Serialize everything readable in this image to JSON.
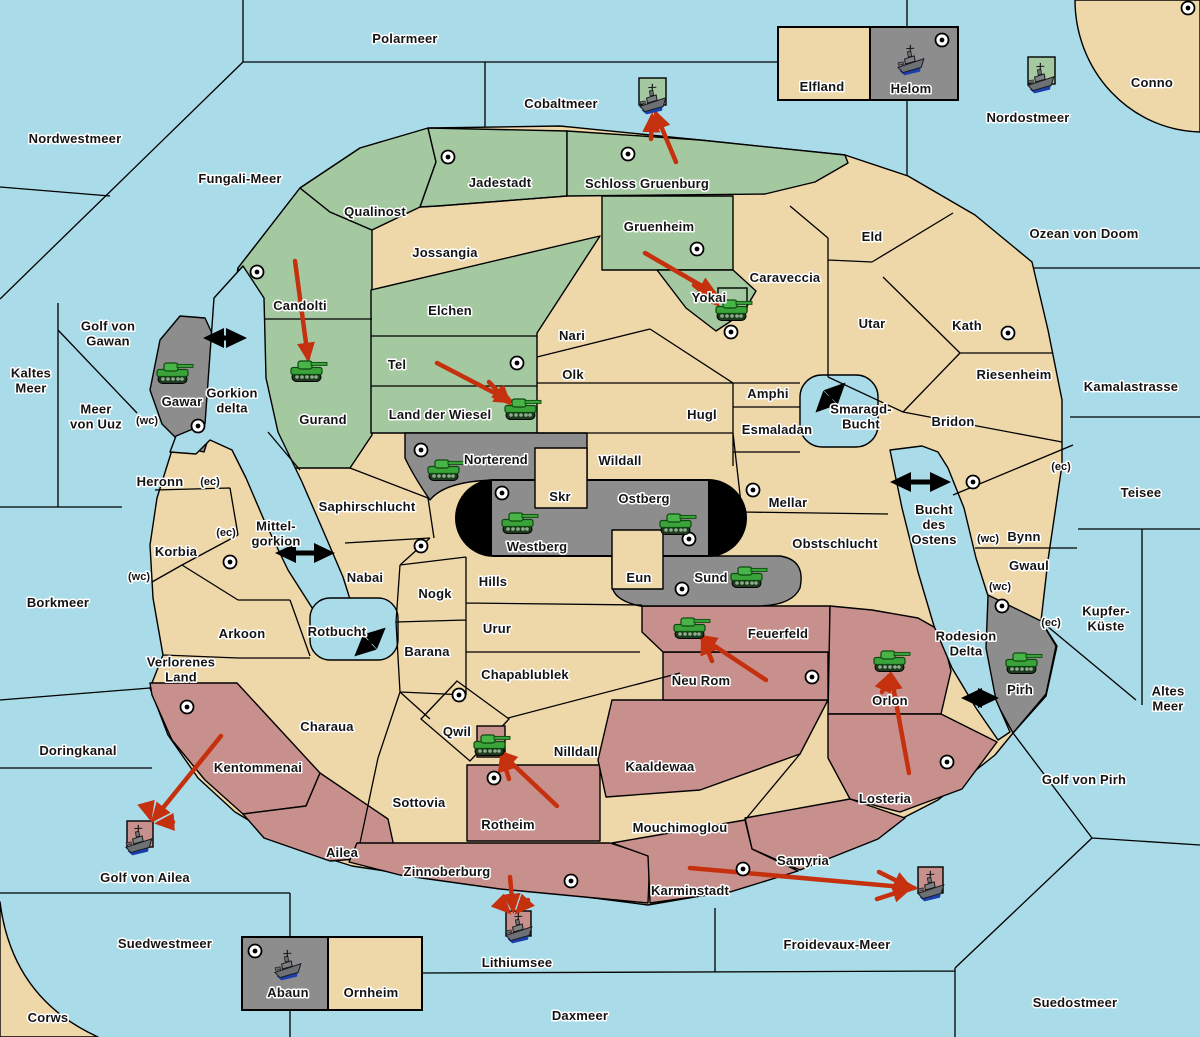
{
  "map": {
    "size": {
      "w": 1200,
      "h": 1037
    },
    "colors": {
      "sea": "#a9dbe8",
      "land": "#eed7a8",
      "green": "#a4c8a0",
      "gray": "#8d8d8d",
      "rose": "#c8908c",
      "black": "#000000",
      "arrow_red": "#c5310e",
      "label": "#141414",
      "halo": "#ffffff",
      "tank": "#3aa33a",
      "ship_hull": "#6d7175",
      "ship_keel": "#1c3fae"
    },
    "labels": [
      {
        "t": [
          "Polarmeer"
        ],
        "x": 405,
        "y": 38,
        "k": "sea"
      },
      {
        "t": [
          "Nordwestmeer"
        ],
        "x": 75,
        "y": 138,
        "k": "sea"
      },
      {
        "t": [
          "Fungali-Meer"
        ],
        "x": 240,
        "y": 178,
        "k": "sea"
      },
      {
        "t": [
          "Cobaltmeer"
        ],
        "x": 561,
        "y": 103,
        "k": "sea"
      },
      {
        "t": [
          "Nordostmeer"
        ],
        "x": 1028,
        "y": 117,
        "k": "sea"
      },
      {
        "t": [
          "Conno"
        ],
        "x": 1152,
        "y": 82,
        "k": "land"
      },
      {
        "t": [
          "Ozean von Doom"
        ],
        "x": 1084,
        "y": 233,
        "k": "sea"
      },
      {
        "t": [
          "Kamalastrasse"
        ],
        "x": 1131,
        "y": 386,
        "k": "sea"
      },
      {
        "t": [
          "Teisee"
        ],
        "x": 1141,
        "y": 492,
        "k": "sea"
      },
      {
        "t": [
          "Kupfer-",
          "Küste"
        ],
        "x": 1106,
        "y": 618,
        "k": "sea"
      },
      {
        "t": [
          "Altes",
          "Meer"
        ],
        "x": 1168,
        "y": 698,
        "k": "sea"
      },
      {
        "t": [
          "Golf von Pirh"
        ],
        "x": 1084,
        "y": 779,
        "k": "sea"
      },
      {
        "t": [
          "Froidevaux-Meer"
        ],
        "x": 837,
        "y": 944,
        "k": "sea"
      },
      {
        "t": [
          "Suedostmeer"
        ],
        "x": 1075,
        "y": 1002,
        "k": "sea"
      },
      {
        "t": [
          "Daxmeer"
        ],
        "x": 580,
        "y": 1015,
        "k": "sea"
      },
      {
        "t": [
          "Suedwestmeer"
        ],
        "x": 165,
        "y": 943,
        "k": "sea"
      },
      {
        "t": [
          "Corws"
        ],
        "x": 48,
        "y": 1017,
        "k": "land"
      },
      {
        "t": [
          "Doringkanal"
        ],
        "x": 78,
        "y": 750,
        "k": "sea"
      },
      {
        "t": [
          "Borkmeer"
        ],
        "x": 58,
        "y": 602,
        "k": "sea"
      },
      {
        "t": [
          "Kaltes",
          "Meer"
        ],
        "x": 31,
        "y": 380,
        "k": "sea"
      },
      {
        "t": [
          "Meer",
          "von Uuz"
        ],
        "x": 96,
        "y": 416,
        "k": "sea"
      },
      {
        "t": [
          "Golf von",
          "Gawan"
        ],
        "x": 108,
        "y": 333,
        "k": "sea"
      },
      {
        "t": [
          "Golf von Ailea"
        ],
        "x": 145,
        "y": 877,
        "k": "sea"
      },
      {
        "t": [
          "Lithiumsee"
        ],
        "x": 517,
        "y": 962,
        "k": "sea"
      },
      {
        "t": [
          "Gorkion",
          "delta"
        ],
        "x": 232,
        "y": 400,
        "k": "sea"
      },
      {
        "t": [
          "Mittel-",
          "gorkion"
        ],
        "x": 276,
        "y": 533,
        "k": "sea"
      },
      {
        "t": [
          "Rotbucht"
        ],
        "x": 337,
        "y": 631,
        "k": "sea"
      },
      {
        "t": [
          "Smaragd-",
          "Bucht"
        ],
        "x": 861,
        "y": 416,
        "k": "sea"
      },
      {
        "t": [
          "Bucht",
          "des",
          "Ostens"
        ],
        "x": 934,
        "y": 524,
        "k": "sea"
      },
      {
        "t": [
          "Rodesion",
          "Delta"
        ],
        "x": 966,
        "y": 643,
        "k": "sea"
      },
      {
        "t": [
          "Jadestadt"
        ],
        "x": 500,
        "y": 182,
        "k": "land"
      },
      {
        "t": [
          "Schloss Gruenburg"
        ],
        "x": 647,
        "y": 183,
        "k": "land"
      },
      {
        "t": [
          "Qualinost"
        ],
        "x": 375,
        "y": 211,
        "k": "land"
      },
      {
        "t": [
          "Jossangia"
        ],
        "x": 445,
        "y": 252,
        "k": "land"
      },
      {
        "t": [
          "Gruenheim"
        ],
        "x": 659,
        "y": 226,
        "k": "land"
      },
      {
        "t": [
          "Candolti"
        ],
        "x": 300,
        "y": 305,
        "k": "land"
      },
      {
        "t": [
          "Elchen"
        ],
        "x": 450,
        "y": 310,
        "k": "land"
      },
      {
        "t": [
          "Tel"
        ],
        "x": 397,
        "y": 364,
        "k": "land"
      },
      {
        "t": [
          "Nari"
        ],
        "x": 572,
        "y": 335,
        "k": "land"
      },
      {
        "t": [
          "Olk"
        ],
        "x": 573,
        "y": 374,
        "k": "land"
      },
      {
        "t": [
          "Land der Wiesel"
        ],
        "x": 440,
        "y": 414,
        "k": "land"
      },
      {
        "t": [
          "Gurand"
        ],
        "x": 323,
        "y": 419,
        "k": "land"
      },
      {
        "t": [
          "Gawar"
        ],
        "x": 182,
        "y": 401,
        "k": "land"
      },
      {
        "t": [
          "Yokai"
        ],
        "x": 709,
        "y": 297,
        "k": "land"
      },
      {
        "t": [
          "Caraveccia"
        ],
        "x": 785,
        "y": 277,
        "k": "land"
      },
      {
        "t": [
          "Eld"
        ],
        "x": 872,
        "y": 236,
        "k": "land"
      },
      {
        "t": [
          "Utar"
        ],
        "x": 872,
        "y": 323,
        "k": "land"
      },
      {
        "t": [
          "Kath"
        ],
        "x": 967,
        "y": 325,
        "k": "land"
      },
      {
        "t": [
          "Riesenheim"
        ],
        "x": 1014,
        "y": 374,
        "k": "land"
      },
      {
        "t": [
          "Bridon"
        ],
        "x": 953,
        "y": 421,
        "k": "land"
      },
      {
        "t": [
          "Amphi"
        ],
        "x": 768,
        "y": 393,
        "k": "land"
      },
      {
        "t": [
          "Esmaladan"
        ],
        "x": 777,
        "y": 429,
        "k": "land"
      },
      {
        "t": [
          "Hugl"
        ],
        "x": 702,
        "y": 414,
        "k": "land"
      },
      {
        "t": [
          "Wildall"
        ],
        "x": 620,
        "y": 460,
        "k": "land"
      },
      {
        "t": [
          "Skr"
        ],
        "x": 560,
        "y": 496,
        "k": "land"
      },
      {
        "t": [
          "Ostberg"
        ],
        "x": 644,
        "y": 498,
        "k": "land"
      },
      {
        "t": [
          "Westberg"
        ],
        "x": 537,
        "y": 546,
        "k": "land"
      },
      {
        "t": [
          "Norterend"
        ],
        "x": 496,
        "y": 459,
        "k": "land"
      },
      {
        "t": [
          "Eun"
        ],
        "x": 639,
        "y": 577,
        "k": "land"
      },
      {
        "t": [
          "Sund"
        ],
        "x": 711,
        "y": 577,
        "k": "land"
      },
      {
        "t": [
          "Mellar"
        ],
        "x": 788,
        "y": 502,
        "k": "land"
      },
      {
        "t": [
          "Obstschlucht"
        ],
        "x": 835,
        "y": 543,
        "k": "land"
      },
      {
        "t": [
          "Saphirschlucht"
        ],
        "x": 367,
        "y": 506,
        "k": "land"
      },
      {
        "t": [
          "Heronn"
        ],
        "x": 160,
        "y": 481,
        "k": "land"
      },
      {
        "t": [
          "Korbia"
        ],
        "x": 176,
        "y": 551,
        "k": "land"
      },
      {
        "t": [
          "Nabai"
        ],
        "x": 365,
        "y": 577,
        "k": "land"
      },
      {
        "t": [
          "Nogk"
        ],
        "x": 435,
        "y": 593,
        "k": "land"
      },
      {
        "t": [
          "Arkoon"
        ],
        "x": 242,
        "y": 633,
        "k": "land"
      },
      {
        "t": [
          "Verlorenes",
          "Land"
        ],
        "x": 181,
        "y": 669,
        "k": "land"
      },
      {
        "t": [
          "Hills"
        ],
        "x": 493,
        "y": 581,
        "k": "land"
      },
      {
        "t": [
          "Urur"
        ],
        "x": 497,
        "y": 628,
        "k": "land"
      },
      {
        "t": [
          "Barana"
        ],
        "x": 427,
        "y": 651,
        "k": "land"
      },
      {
        "t": [
          "Chapablublek"
        ],
        "x": 525,
        "y": 674,
        "k": "land"
      },
      {
        "t": [
          "Charaua"
        ],
        "x": 327,
        "y": 726,
        "k": "land"
      },
      {
        "t": [
          "Kentommenai"
        ],
        "x": 258,
        "y": 767,
        "k": "land"
      },
      {
        "t": [
          "Sottovia"
        ],
        "x": 419,
        "y": 802,
        "k": "land"
      },
      {
        "t": [
          "Ailea"
        ],
        "x": 342,
        "y": 852,
        "k": "land"
      },
      {
        "t": [
          "Zinnoberburg"
        ],
        "x": 447,
        "y": 871,
        "k": "land"
      },
      {
        "t": [
          "Rotheim"
        ],
        "x": 508,
        "y": 824,
        "k": "land"
      },
      {
        "t": [
          "Qwil"
        ],
        "x": 457,
        "y": 731,
        "k": "land"
      },
      {
        "t": [
          "Nilldall"
        ],
        "x": 576,
        "y": 751,
        "k": "land"
      },
      {
        "t": [
          "Kaaldewaa"
        ],
        "x": 660,
        "y": 766,
        "k": "land"
      },
      {
        "t": [
          "Mouchimoglou"
        ],
        "x": 680,
        "y": 827,
        "k": "land"
      },
      {
        "t": [
          "Neu Rom"
        ],
        "x": 701,
        "y": 680,
        "k": "land"
      },
      {
        "t": [
          "Feuerfeld"
        ],
        "x": 778,
        "y": 633,
        "k": "land"
      },
      {
        "t": [
          "Orlon"
        ],
        "x": 890,
        "y": 700,
        "k": "land"
      },
      {
        "t": [
          "Losteria"
        ],
        "x": 885,
        "y": 798,
        "k": "land"
      },
      {
        "t": [
          "Samyria"
        ],
        "x": 803,
        "y": 860,
        "k": "land"
      },
      {
        "t": [
          "Karminstadt"
        ],
        "x": 690,
        "y": 890,
        "k": "land"
      },
      {
        "t": [
          "Bynn"
        ],
        "x": 1024,
        "y": 536,
        "k": "land"
      },
      {
        "t": [
          "Gwaul"
        ],
        "x": 1029,
        "y": 565,
        "k": "land"
      },
      {
        "t": [
          "Pirh"
        ],
        "x": 1020,
        "y": 689,
        "k": "land"
      },
      {
        "t": [
          "Elfland"
        ],
        "x": 822,
        "y": 86,
        "k": "land"
      },
      {
        "t": [
          "Helom"
        ],
        "x": 911,
        "y": 88,
        "k": "land"
      },
      {
        "t": [
          "Abaun"
        ],
        "x": 288,
        "y": 992,
        "k": "land"
      },
      {
        "t": [
          "Ornheim"
        ],
        "x": 371,
        "y": 992,
        "k": "land"
      }
    ],
    "coast_markers": [
      {
        "t": "(ec)",
        "x": 210,
        "y": 481
      },
      {
        "t": "(ec)",
        "x": 226,
        "y": 532
      },
      {
        "t": "(wc)",
        "x": 139,
        "y": 576
      },
      {
        "t": "(wc)",
        "x": 147,
        "y": 420
      },
      {
        "t": "(ec)",
        "x": 1061,
        "y": 466
      },
      {
        "t": "(wc)",
        "x": 988,
        "y": 538
      },
      {
        "t": "(wc)",
        "x": 1000,
        "y": 586
      },
      {
        "t": "(ec)",
        "x": 1051,
        "y": 622
      }
    ],
    "supply_centers": [
      [
        448,
        157
      ],
      [
        628,
        154
      ],
      [
        257,
        272
      ],
      [
        697,
        249
      ],
      [
        731,
        332
      ],
      [
        517,
        363
      ],
      [
        198,
        426
      ],
      [
        230,
        562
      ],
      [
        421,
        546
      ],
      [
        421,
        450
      ],
      [
        502,
        493
      ],
      [
        689,
        539
      ],
      [
        682,
        589
      ],
      [
        753,
        490
      ],
      [
        1008,
        333
      ],
      [
        973,
        482
      ],
      [
        1002,
        606
      ],
      [
        187,
        707
      ],
      [
        459,
        695
      ],
      [
        494,
        778
      ],
      [
        812,
        677
      ],
      [
        947,
        762
      ],
      [
        571,
        881
      ],
      [
        743,
        869
      ],
      [
        942,
        40
      ],
      [
        255,
        951
      ],
      [
        1188,
        8
      ]
    ],
    "unit_boxes": [
      {
        "x": 639,
        "y": 78,
        "w": 27,
        "h": 27,
        "c": "green"
      },
      {
        "x": 1028,
        "y": 57,
        "w": 27,
        "h": 27,
        "c": "green"
      },
      {
        "x": 718,
        "y": 288,
        "w": 29,
        "h": 23,
        "c": "green"
      },
      {
        "x": 477,
        "y": 726,
        "w": 28,
        "h": 31,
        "c": "rose"
      },
      {
        "x": 127,
        "y": 821,
        "w": 26,
        "h": 26,
        "c": "rose"
      },
      {
        "x": 506,
        "y": 911,
        "w": 25,
        "h": 25,
        "c": "rose"
      },
      {
        "x": 918,
        "y": 867,
        "w": 25,
        "h": 26,
        "c": "rose"
      }
    ],
    "units": [
      {
        "type": "army",
        "at": "Gawar",
        "x": 173,
        "y": 373
      },
      {
        "type": "army",
        "at": "Gurand",
        "x": 307,
        "y": 371
      },
      {
        "type": "army",
        "at": "Land der Wiesel",
        "x": 521,
        "y": 409
      },
      {
        "type": "army",
        "at": "Norterend",
        "x": 444,
        "y": 470
      },
      {
        "type": "army",
        "at": "Westberg",
        "x": 518,
        "y": 523
      },
      {
        "type": "army",
        "at": "Ostberg",
        "x": 676,
        "y": 524
      },
      {
        "type": "army",
        "at": "Sund",
        "x": 747,
        "y": 577
      },
      {
        "type": "army",
        "at": "Yokai",
        "x": 732,
        "y": 310
      },
      {
        "type": "army",
        "at": "Qwil",
        "x": 490,
        "y": 745
      },
      {
        "type": "army",
        "at": "Feuerfeld",
        "x": 690,
        "y": 628
      },
      {
        "type": "army",
        "at": "Orlon",
        "x": 890,
        "y": 661
      },
      {
        "type": "army",
        "at": "Pirh",
        "x": 1022,
        "y": 663
      },
      {
        "type": "fleet",
        "at": "Cobaltmeer",
        "x": 653,
        "y": 100
      },
      {
        "type": "fleet",
        "at": "Nordostmeer",
        "x": 1041,
        "y": 79
      },
      {
        "type": "fleet",
        "at": "Helom",
        "x": 911,
        "y": 61
      },
      {
        "type": "fleet",
        "at": "Abaun",
        "x": 288,
        "y": 966
      },
      {
        "type": "fleet",
        "at": "Golf von Ailea",
        "x": 139,
        "y": 841
      },
      {
        "type": "fleet",
        "at": "Lithiumsee",
        "x": 519,
        "y": 929
      },
      {
        "type": "fleet",
        "at": "Froidevaux-Meer",
        "x": 931,
        "y": 887
      }
    ],
    "move_arrows": [
      [
        295,
        261,
        308,
        358
      ],
      [
        437,
        363,
        510,
        401
      ],
      [
        489,
        382,
        508,
        402
      ],
      [
        645,
        253,
        714,
        293
      ],
      [
        694,
        285,
        716,
        303
      ],
      [
        676,
        162,
        656,
        114
      ],
      [
        651,
        139,
        652,
        117
      ],
      [
        766,
        680,
        701,
        637
      ],
      [
        712,
        661,
        703,
        639
      ],
      [
        909,
        773,
        891,
        675
      ],
      [
        882,
        692,
        889,
        676
      ],
      [
        221,
        736,
        154,
        819
      ],
      [
        147,
        806,
        150,
        817
      ],
      [
        173,
        822,
        159,
        823
      ],
      [
        557,
        806,
        501,
        753
      ],
      [
        509,
        779,
        502,
        756
      ],
      [
        510,
        877,
        513,
        909
      ],
      [
        528,
        900,
        518,
        911
      ],
      [
        499,
        902,
        508,
        911
      ],
      [
        690,
        868,
        914,
        888
      ],
      [
        879,
        872,
        909,
        887
      ],
      [
        877,
        899,
        908,
        889
      ]
    ],
    "strait_arrows": [
      [
        208,
        338,
        242,
        338
      ],
      [
        280,
        553,
        330,
        553
      ],
      [
        358,
        653,
        382,
        631
      ],
      [
        819,
        409,
        842,
        386
      ],
      [
        895,
        482,
        946,
        482
      ],
      [
        966,
        698,
        994,
        698
      ]
    ]
  }
}
